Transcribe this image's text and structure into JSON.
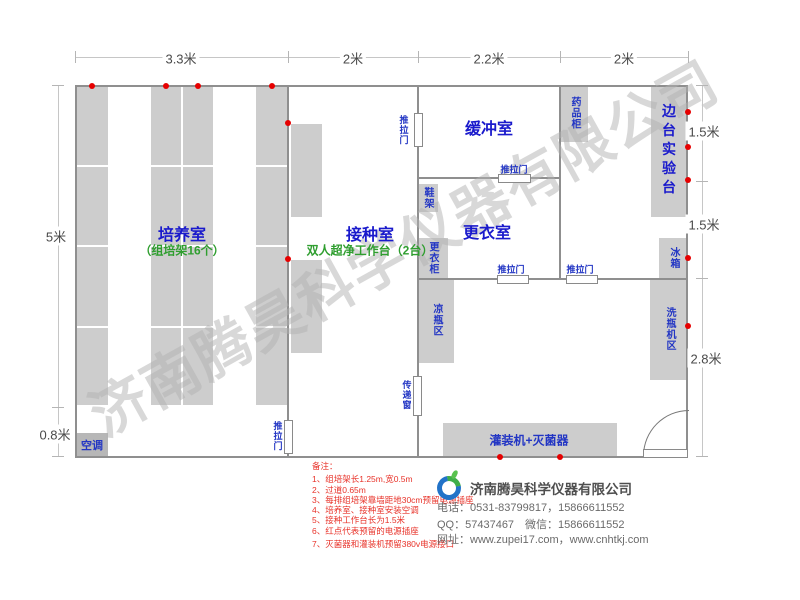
{
  "dimensions": {
    "top": [
      "3.3米",
      "2米",
      "2.2米",
      "2米"
    ],
    "left": [
      "5米",
      "0.8米"
    ],
    "right": [
      "1.5米",
      "1.5米",
      "2.8米"
    ]
  },
  "rooms": {
    "cultivation": {
      "name": "培养室",
      "subtitle": "（组培架16个）"
    },
    "inoculation": {
      "name": "接种室",
      "subtitle": "双人超净工作台（2台）"
    },
    "buffer": {
      "name": "缓冲室"
    },
    "changing": {
      "name": "更衣室"
    }
  },
  "fixtures": {
    "side_bench": "边台实验台",
    "medicine_cabinet": "药品柜",
    "fridge": "冰箱",
    "washer_area": "洗瓶机区",
    "cooling_area": "凉瓶区",
    "wardrobe": "更衣柜",
    "shoe_rack": "鞋架",
    "filler_sterilizer": "灌装机+灭菌器",
    "air_conditioner": "空调",
    "transfer_window": "传递窗",
    "sliding_door": "推拉门"
  },
  "notes": {
    "title": "备注：",
    "items": [
      "1、组培架长1.25m,宽0.5m",
      "2、过道0.65m",
      "3、每排组培架靠墙距地30cm预留电源插座",
      "4、培养室、接种室安装空调",
      "5、接种工作台长为1.5米",
      "6、红点代表预留的电源插座",
      "7、灭菌器和灌装机预留380v电源接口"
    ]
  },
  "company": {
    "name": "济南腾昊科学仪器有限公司",
    "phone": "电话：0531-83799817，15866611552",
    "qq": "QQ：57437467　微信：15866611552",
    "website": "网址：www.zupei17.com，www.cnhtkj.com"
  },
  "watermark": "济南腾昊科学仪器有限公司",
  "colors": {
    "wall": "#8f8f8f",
    "fixture_fill": "#cdcdcd",
    "room_label": "#1a1acc",
    "sub_label": "#2f9e2f",
    "note_red": "#e8332a",
    "socket_dot": "#e60000",
    "watermark_gray": "#b2b2b2"
  }
}
